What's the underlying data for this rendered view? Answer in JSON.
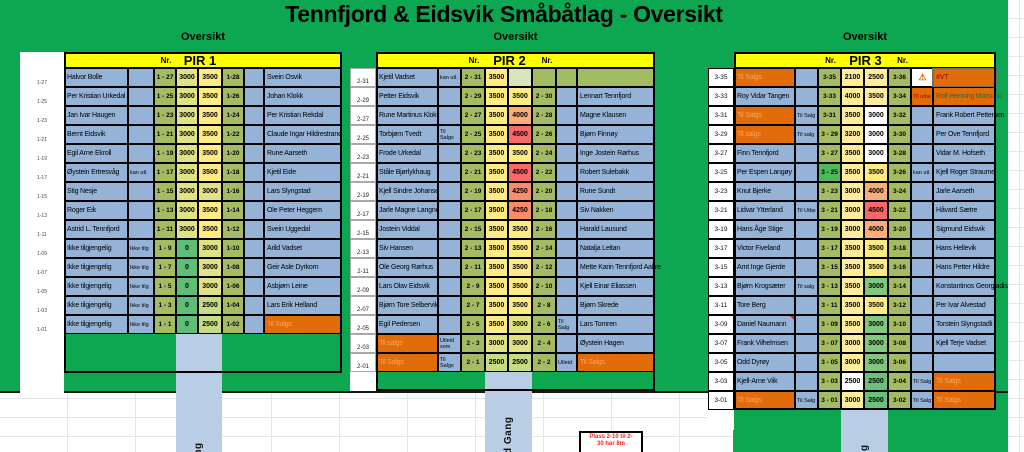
{
  "title": "Tennfjord & Eidsvik Småbåtlag - Oversikt",
  "note_box": {
    "lines": [
      "Plass 2-10 til 2-",
      "30 har 8m"
    ],
    "text_color": "#FF2020"
  },
  "icons": {
    "warning": "⚠"
  },
  "palette": {
    "green_bg": "#0CA750",
    "yellow_header": "#FFFF00",
    "blue": "#95B3D7",
    "walkway": "#B9CDE5",
    "olive": "#A3BC64",
    "bright_green": "#4CB857",
    "g0": "#5CBE77",
    "orange": "#E26B0A",
    "orange_text": "#F5A963",
    "cream": "#FFEC9F",
    "white": "#FFFFFF",
    "y3500": "#FFEB84",
    "y3000": "#E0E284",
    "g2500": "#C6DC82",
    "green3000": "#82C77E",
    "green2500": "#68C17C",
    "o4000": "#FBAC78",
    "r4250": "#FA8A70",
    "r4500": "#F8696B",
    "palegreen": "#D8E4BC",
    "darkred": "#9C0006",
    "darkgreen": "#2F6B2F"
  },
  "piers": [
    {
      "name": "PIR 1",
      "section_label": "Oversikt",
      "nr_label": "Nr.",
      "nr_label_right": "",
      "walkway_label": "Gang",
      "rows": [
        {
          "m": "1-27",
          "l": "Halvor Bolle",
          "cl": "1 - 27",
          "p1": "3000",
          "p1c": "y3000",
          "p2": "3500",
          "p2c": "y3500",
          "cr": "1-28",
          "r": "Svein Osvik"
        },
        {
          "m": "1-25",
          "l": "Per Kristian Urkedal",
          "cl": "1 - 25",
          "p1": "3000",
          "p1c": "y3000",
          "p2": "3500",
          "p2c": "y3500",
          "cr": "1-26",
          "r": "Johan Klokk"
        },
        {
          "m": "1-23",
          "l": "Jan Ivar Haugen",
          "cl": "1 - 23",
          "p1": "3000",
          "p1c": "y3000",
          "p2": "3500",
          "p2c": "y3500",
          "cr": "1-24",
          "r": "Per Kristian Rekdal"
        },
        {
          "m": "1-21",
          "l": "Bernt Eidsvik",
          "cl": "1 - 21",
          "p1": "3000",
          "p1c": "y3000",
          "p2": "3500",
          "p2c": "y3500",
          "cr": "1-22",
          "r": "Claude Ingar Hildrestrand"
        },
        {
          "m": "1-19",
          "l": "Egil Arne Ekroll",
          "cl": "1 - 19",
          "p1": "3000",
          "p1c": "y3000",
          "p2": "3500",
          "p2c": "y3500",
          "cr": "1-20",
          "r": "Rune Aarseth"
        },
        {
          "m": "1-17",
          "l": "Øystein Ertresvåg",
          "ln": "kan utl.",
          "cl": "1 - 17",
          "p1": "3000",
          "p1c": "y3000",
          "p2": "3500",
          "p2c": "y3500",
          "cr": "1-18",
          "r": "Kjetil Eide"
        },
        {
          "m": "1-15",
          "l": "Stig Nesje",
          "cl": "1 - 15",
          "p1": "3000",
          "p1c": "y3000",
          "p2": "3000",
          "p2c": "y3000",
          "cr": "1-16",
          "r": "Lars Slyngstad"
        },
        {
          "m": "1-13",
          "l": "Roger Eik",
          "cl": "1 - 13",
          "p1": "3000",
          "p1c": "y3000",
          "p2": "3500",
          "p2c": "y3500",
          "cr": "1-14",
          "r": "Ole Peter Heggem"
        },
        {
          "m": "1-11",
          "l": "Astrid L. Tennfjord",
          "cl": "1 - 11",
          "p1": "3000",
          "p1c": "y3000",
          "p2": "3500",
          "p2c": "y3500",
          "cr": "1-12",
          "r": "Svein Uggedal"
        },
        {
          "m": "1-09",
          "l": "Ikke tilgjengelig",
          "ln": "Ikke tilg",
          "cl": "1 - 9",
          "p1": "0",
          "p1c": "g0",
          "p2": "3000",
          "p2c": "y3000",
          "cr": "1-10",
          "r": "Arild Vadset"
        },
        {
          "m": "1-07",
          "l": "Ikke tilgjengelig",
          "ln": "Ikke tilg",
          "cl": "1 - 7",
          "p1": "0",
          "p1c": "g0",
          "p2": "3000",
          "p2c": "y3000",
          "cr": "1-08",
          "r": "Geir Asle Dyrkorn"
        },
        {
          "m": "1-05",
          "l": "Ikke tilgjengelig",
          "ln": "Ikke tilg",
          "cl": "1 - 5",
          "p1": "0",
          "p1c": "g0",
          "p2": "3000",
          "p2c": "y3000",
          "cr": "1-06",
          "r": "Asbjørn Leine"
        },
        {
          "m": "1-03",
          "l": "Ikke tilgjengelig",
          "ln": "Ikke tilg",
          "cl": "1 - 3",
          "p1": "0",
          "p1c": "g0",
          "p2": "2500",
          "p2c": "g2500",
          "cr": "1-04",
          "r": "Lars Erik Helland"
        },
        {
          "m": "1-01",
          "l": "Ikke tilgjengelig",
          "ln": "Ikke tilg",
          "cl": "1 - 1",
          "p1": "0",
          "p1c": "g0",
          "p2": "2500",
          "p2c": "g2500",
          "cr": "1-02",
          "r": "Til Salgs",
          "rbg": "orange",
          "rfg": "orange_text"
        }
      ]
    },
    {
      "name": "PIR 2",
      "section_label": "Oversikt",
      "nr_label": "Nr.",
      "nr_label_right": "Nr.",
      "walkway_label": "d Gang",
      "rows": [
        {
          "m": "2-31",
          "l": "Kjetil Vadset",
          "ln": "kan utl.",
          "cl": "2 - 31",
          "p1": "3500",
          "p1c": "y3500",
          "p2": "",
          "p2c": "palegreen",
          "cr": "",
          "nr": "",
          "nrbg": "olive",
          "r": "",
          "rbg": "olive"
        },
        {
          "m": "2-29",
          "l": "Petter Eidsvik",
          "cl": "2 - 29",
          "p1": "3500",
          "p1c": "y3500",
          "p2": "3500",
          "p2c": "y3500",
          "cr": "2 - 30",
          "r": "Lennart Tennfjord"
        },
        {
          "m": "2-27",
          "l": "Rune Martinus Klokseth",
          "cl": "2 - 27",
          "p1": "3500",
          "p1c": "y3500",
          "p2": "4000",
          "p2c": "o4000",
          "cr": "2 - 28",
          "r": "Magne Klausen"
        },
        {
          "m": "2-25",
          "l": "Torbjørn Tvedt",
          "ln": "Til Salgs",
          "cl": "2 - 25",
          "p1": "3500",
          "p1c": "y3500",
          "p2": "4500",
          "p2c": "r4500",
          "cr": "2 - 26",
          "r": "Bjørn Finnøy"
        },
        {
          "m": "2-23",
          "l": "Frode Urkedal",
          "cl": "2 - 23",
          "p1": "3500",
          "p1c": "y3500",
          "p2": "3500",
          "p2c": "y3500",
          "cr": "2 - 24",
          "r": "Inge Jostein Rørhus"
        },
        {
          "m": "2-21",
          "l": "Ståle Bjørlykhaug",
          "cl": "2 - 21",
          "p1": "3500",
          "p1c": "y3500",
          "p2": "4500",
          "p2c": "r4500",
          "cr": "2 - 22",
          "r": "Robert Sulebakk"
        },
        {
          "m": "2-19",
          "l": "Kjell Sindre Johansen",
          "cl": "2 - 19",
          "p1": "3500",
          "p1c": "y3500",
          "p2": "4250",
          "p2c": "r4250",
          "cr": "2 - 20",
          "r": "Rune Sundt"
        },
        {
          "m": "2-17",
          "l": "Jarle Magne Langnes",
          "cl": "2 - 17",
          "p1": "3500",
          "p1c": "y3500",
          "p2": "4250",
          "p2c": "r4250",
          "cr": "2 - 18",
          "r": "Siv Nakken"
        },
        {
          "m": "2-15",
          "l": "Jostein Viddal",
          "cl": "2 - 15",
          "p1": "3500",
          "p1c": "y3500",
          "p2": "3500",
          "p2c": "y3500",
          "cr": "2 - 16",
          "r": "Harald Lausund"
        },
        {
          "m": "2-13",
          "l": "Siv Hansen",
          "cl": "2 - 13",
          "p1": "3500",
          "p1c": "y3500",
          "p2": "3500",
          "p2c": "y3500",
          "cr": "2 - 14",
          "r": "Natalja Leitan"
        },
        {
          "m": "2-11",
          "l": "Ole Georg Rørhus",
          "cl": "2 - 11",
          "p1": "3500",
          "p1c": "y3500",
          "p2": "3500",
          "p2c": "y3500",
          "cr": "2 - 12",
          "r": "Mette Karin Tennfjord Aakre"
        },
        {
          "m": "2-09",
          "l": "Lars Olav Eidsvik",
          "cl": "2 - 9",
          "p1": "3500",
          "p1c": "y3500",
          "p2": "3500",
          "p2c": "y3500",
          "cr": "2 - 10",
          "r": "Kjell Einar Eliassen"
        },
        {
          "m": "2-07",
          "l": "Bjørn Tore Selbervik",
          "cl": "2 - 7",
          "p1": "3500",
          "p1c": "y3500",
          "p2": "3500",
          "p2c": "y3500",
          "cr": "2 - 8",
          "r": "Bjørn Skrede"
        },
        {
          "m": "2-05",
          "l": "Egil Pedersen",
          "cl": "2 - 5",
          "p1": "3500",
          "p1c": "y3500",
          "p2": "3000",
          "p2c": "y3000",
          "cr": "2 - 6",
          "nr": "Til Salg",
          "r": "Lars Tomren"
        },
        {
          "m": "2-03",
          "l": "Til salgs",
          "lbg": "orange",
          "lfg": "orange_text",
          "ln": "Utleid som",
          "cl": "2 - 3",
          "p1": "3000",
          "p1c": "y3000",
          "p2": "3000",
          "p2c": "y3000",
          "cr": "2 - 4",
          "r": "Øystein Hagen"
        },
        {
          "m": "2-01",
          "l": "Til Salgs",
          "lbg": "orange",
          "lfg": "orange_text",
          "ln": "Til Salgs",
          "cl": "2 - 1",
          "p1": "2500",
          "p1c": "g2500",
          "p2": "2500",
          "p2c": "g2500",
          "cr": "2 - 2",
          "nr": "Utleid",
          "r": "Til Salgs",
          "rbg": "orange",
          "rfg": "orange_text"
        }
      ]
    },
    {
      "name": "PIR 3",
      "section_label": "Oversikt",
      "nr_label": "Nr.",
      "nr_label_right": "Nr.",
      "walkway_label": "Gang",
      "rows": [
        {
          "m": "3-35",
          "l": "Til Salgs",
          "lbg": "orange",
          "lfg": "orange_text",
          "cl": "3-35",
          "p1": "2100",
          "p1c": "cream",
          "p2": "2500",
          "p2c": "cream",
          "cr": "3-36",
          "nr_icon": "warning",
          "r": "#VT",
          "rbg": "orange",
          "rfg": "darkred",
          "rsel": true
        },
        {
          "m": "3-33",
          "l": "Roy Vidar Tangen",
          "cl": "3-33",
          "p1": "4000",
          "p1c": "cream",
          "p2": "3500",
          "p2c": "cream",
          "cr": "3-34",
          "nr": "Til utbe",
          "nrbg": "orange",
          "nrfg": "darkred",
          "r": "Rolf Henning Morsund",
          "rbg": "orange",
          "rfg": "darkgreen"
        },
        {
          "m": "3-31",
          "l": "Til Salgs",
          "lbg": "orange",
          "lfg": "orange_text",
          "ln": "Til Salg",
          "cl": "3-31",
          "p1": "3500",
          "p1c": "cream",
          "p2": "3000",
          "p2c": "white",
          "cr": "3-32",
          "r": "Frank Robert Pettersen"
        },
        {
          "m": "3-29",
          "l": "Til salgs",
          "lbg": "orange",
          "lfg": "orange_text",
          "ln": "Til salg",
          "cl": "3 - 29",
          "p1": "3200",
          "p1c": "cream",
          "p2": "3000",
          "p2c": "white",
          "cr": "3-30",
          "r": "Per Ove Tennfjord"
        },
        {
          "m": "3-27",
          "l": "Finn Tennfjord",
          "cl": "3 - 27",
          "p1": "3500",
          "p1c": "cream",
          "p2": "3000",
          "p2c": "white",
          "cr": "3-28",
          "r": "Vidar M. Hofseth"
        },
        {
          "m": "3-25",
          "l": "Per Espen Langøy",
          "cl": "3 - 25",
          "clc": "bright_green",
          "p1": "3500",
          "p1c": "cream",
          "p2": "3500",
          "p2c": "y3500",
          "cr": "3-26",
          "nr": "kan utl.",
          "r": "Kjell Roger Straume"
        },
        {
          "m": "3-23",
          "l": "Knut Bjerke",
          "cl": "3 - 23",
          "p1": "3000",
          "p1c": "cream",
          "p2": "4000",
          "p2c": "o4000",
          "cr": "3-24",
          "r": "Jarle Aarseth"
        },
        {
          "m": "3-21",
          "l": "Lidvar Ytterland",
          "ln": "Til Utbe",
          "cl": "3 - 21",
          "p1": "3000",
          "p1c": "cream",
          "p2": "4500",
          "p2c": "r4500",
          "cr": "3-22",
          "r": "Håvard Sætre"
        },
        {
          "m": "3-19",
          "l": "Hans Åge Stige",
          "cl": "3 - 19",
          "p1": "3000",
          "p1c": "cream",
          "p2": "4000",
          "p2c": "o4000",
          "cr": "3-20",
          "r": "Sigmund Eidsvik"
        },
        {
          "m": "3-17",
          "l": "Victor Fiveland",
          "cl": "3 - 17",
          "p1": "3500",
          "p1c": "cream",
          "p2": "3500",
          "p2c": "y3500",
          "cr": "3-18",
          "r": "Hans Hellevik"
        },
        {
          "m": "3-15",
          "l": "Arnt Inge Gjerde",
          "cl": "3 - 15",
          "p1": "3500",
          "p1c": "cream",
          "p2": "3500",
          "p2c": "y3500",
          "cr": "3-16",
          "r": "Hans Petter Hildre"
        },
        {
          "m": "3-13",
          "l": "Bjørn Krogsæter",
          "ln": "Til salg",
          "cl": "3 - 13",
          "p1": "3500",
          "p1c": "cream",
          "p2": "3000",
          "p2c": "green3000",
          "cr": "3-14",
          "r": "Konstantinos Georgiadis"
        },
        {
          "m": "3-11",
          "l": "Tore Berg",
          "cl": "3 - 11",
          "p1": "3500",
          "p1c": "cream",
          "p2": "3500",
          "p2c": "y3500",
          "cr": "3-12",
          "r": "Per Ivar Alvestad"
        },
        {
          "m": "3-09",
          "l": "Daniel Naumann",
          "lcm": true,
          "cl": "3 - 09",
          "p1": "3500",
          "p1c": "cream",
          "p2": "3000",
          "p2c": "green3000",
          "cr": "3-10",
          "r": "Torstein Slyngstadli"
        },
        {
          "m": "3-07",
          "l": "Frank Vilhelmsen",
          "cl": "3 - 07",
          "p1": "3000",
          "p1c": "cream",
          "p2": "3000",
          "p2c": "green3000",
          "cr": "3-08",
          "r": "Kjell Terje Vadset"
        },
        {
          "m": "3-05",
          "l": "Odd Dyrøy",
          "cl": "3 - 05",
          "p1": "3000",
          "p1c": "cream",
          "p2": "3000",
          "p2c": "green3000",
          "cr": "3-06",
          "r": ""
        },
        {
          "m": "3-03",
          "l": "Kjell-Arne Viik",
          "cl": "3 - 03",
          "p1": "2500",
          "p1c": "white",
          "p2": "2500",
          "p2c": "green2500",
          "cr": "3-04",
          "nr": "Til Salg",
          "r": "Til Salgs",
          "rbg": "orange",
          "rfg": "orange_text"
        },
        {
          "m": "3-01",
          "l": "Til Salgs",
          "lbg": "orange",
          "lfg": "orange_text",
          "ln": "Til Salg",
          "cl": "3 - 01",
          "p1": "3000",
          "p1c": "cream",
          "p2": "2500",
          "p2c": "green2500",
          "cr": "3-02",
          "nr": "Til Salg",
          "r": "Til Salgs",
          "rbg": "orange",
          "rfg": "orange_text"
        }
      ]
    }
  ]
}
